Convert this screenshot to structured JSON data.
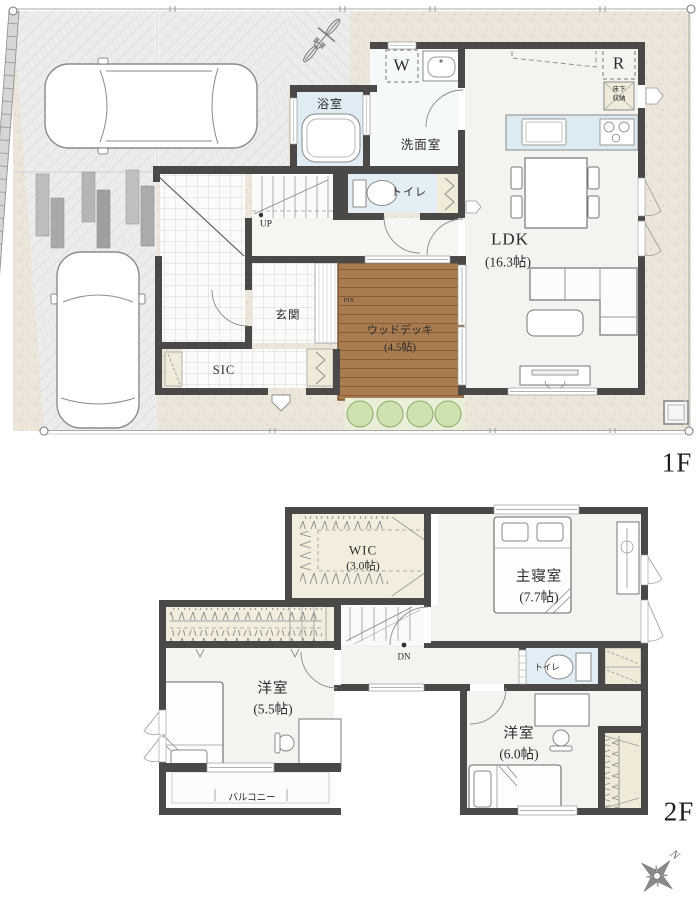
{
  "floor1": {
    "label": "1F",
    "bath": "浴室",
    "washroom": "洗面室",
    "toilet": "トイレ",
    "ldk_name": "LDK",
    "ldk_size": "(16.3帖)",
    "entrance": "玄関",
    "sic": "SIC",
    "deck_name": "ウッドデッキ",
    "deck_size": "(4.5帖)",
    "washer": "W",
    "fridge": "R",
    "underfloor_line1": "床下",
    "underfloor_line2": "収納",
    "stairs_up": "UP",
    "fix_window": "FIX"
  },
  "floor2": {
    "label": "2F",
    "wic_name": "WIC",
    "wic_size": "(3.0帖)",
    "master_name": "主寝室",
    "master_size": "(7.7帖)",
    "toilet": "トイレ",
    "room55_name": "洋室",
    "room55_size": "(5.5帖)",
    "room60_name": "洋室",
    "room60_size": "(6.0帖)",
    "balcony": "バルコニー",
    "stairs_down": "DN"
  },
  "compass": {
    "north": "N"
  },
  "colors": {
    "wall": "#4a4947",
    "water_room": "#e2eef5",
    "closet_cream": "#f0ead8",
    "wood_deck": "#a87b50",
    "room_floor": "#f3f3f0",
    "ground_beige": "#ece5d9",
    "driveway": "#ececec",
    "bush_green": "#cde2b0",
    "text": "#2b2b2b"
  },
  "icons": {
    "car": "car-icon",
    "bicycle": "bicycle-icon",
    "bathtub": "bathtub-icon",
    "washbasin": "washbasin-icon",
    "toilet": "toilet-icon",
    "kitchen_sink": "kitchen-sink-icon",
    "stove": "stove-icon",
    "dining_table": "dining-table-icon",
    "sofa": "sofa-icon",
    "tv": "tv-board-icon",
    "bed": "bed-icon",
    "desk": "desk-icon",
    "chair": "chair-icon",
    "stairs": "stairs-icon",
    "hanger_rack": "hanger-rack-icon",
    "compass": "compass-icon"
  }
}
